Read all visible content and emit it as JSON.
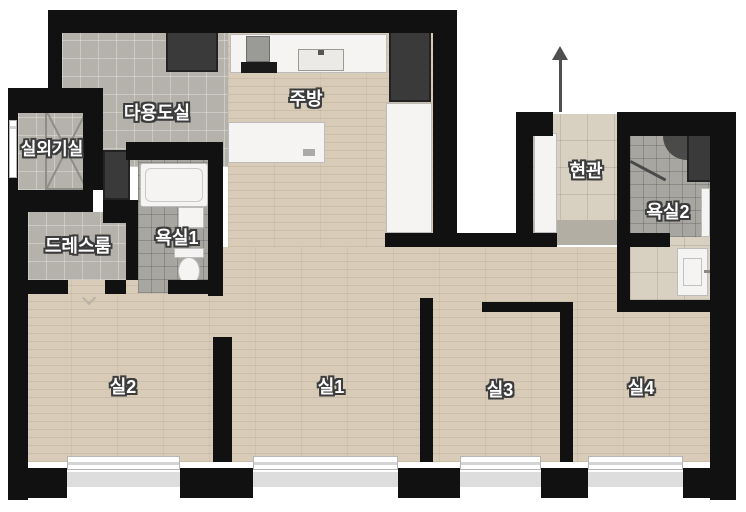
{
  "rooms": [
    {
      "id": "utility-room",
      "label": "다용도실"
    },
    {
      "id": "kitchen",
      "label": "주방"
    },
    {
      "id": "outdoor-unit-room",
      "label": "실외기실"
    },
    {
      "id": "dress-room",
      "label": "드레스룸"
    },
    {
      "id": "bathroom-1",
      "label": "욕실1"
    },
    {
      "id": "entrance",
      "label": "현관"
    },
    {
      "id": "bathroom-2",
      "label": "욕실2"
    },
    {
      "id": "room-2",
      "label": "실2"
    },
    {
      "id": "room-1",
      "label": "실1"
    },
    {
      "id": "room-3",
      "label": "실3"
    },
    {
      "id": "room-4",
      "label": "실4"
    }
  ],
  "colors": {
    "wall": "#111111",
    "wood_floor": "#d8ccb8",
    "tile_gray": "#b4b2ab",
    "tile_bath": "#a8a6a0",
    "tile_entry": "#d8d1c2",
    "closet_dark": "#3a3a3a",
    "fixture_white": "#f5f4f2",
    "background": "#ffffff"
  }
}
